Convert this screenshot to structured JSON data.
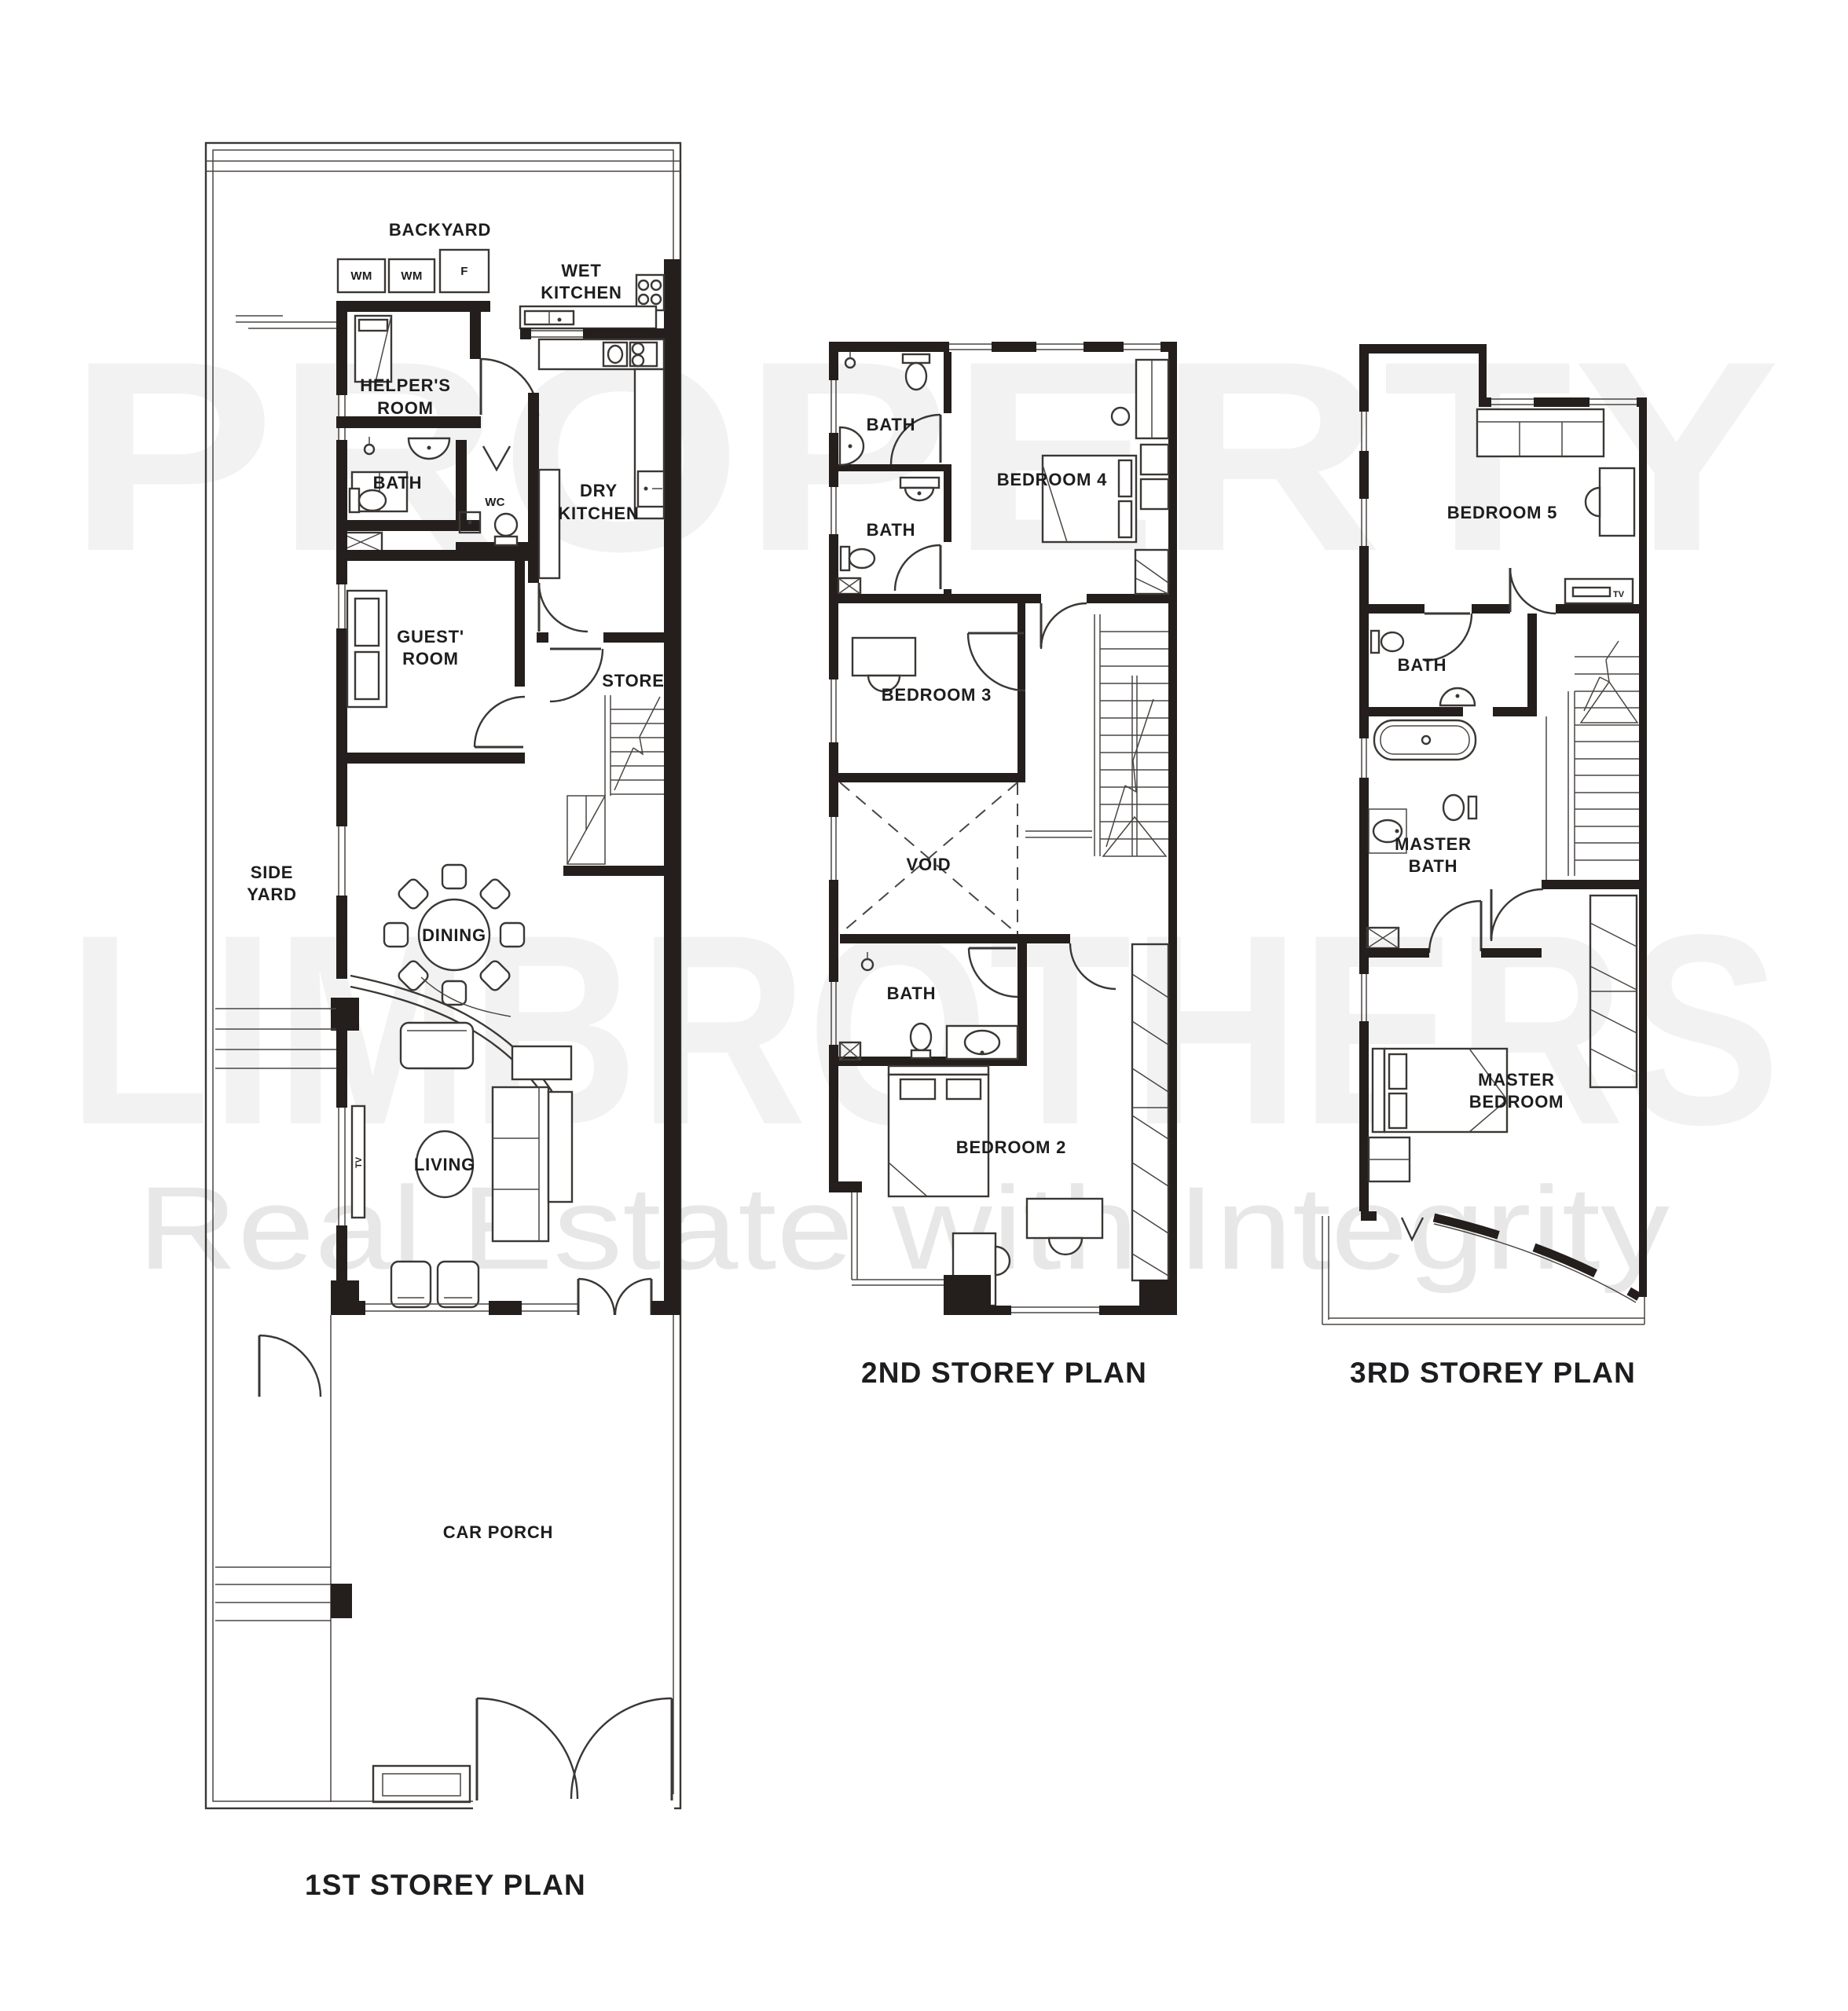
{
  "watermark": {
    "line1": "PROPERTY",
    "line2": "LIMBROTHERS",
    "tagline": "Real Estate with Integrity"
  },
  "plans": {
    "first": {
      "title": "1ST STOREY PLAN",
      "rooms": {
        "backyard": "BACKYARD",
        "wm_left": "WM",
        "wm_right": "WM",
        "fridge": "F",
        "wet_kitchen": [
          "WET",
          "KITCHEN"
        ],
        "helpers_room": [
          "HELPER'S",
          "ROOM"
        ],
        "bath": "BATH",
        "wc": "WC",
        "dry_kitchen": [
          "DRY",
          "KITCHEN"
        ],
        "guest_room": [
          "GUEST'",
          "ROOM"
        ],
        "store": "STORE",
        "side_yard": [
          "SIDE",
          "YARD"
        ],
        "dining": "DINING",
        "living": "LIVING",
        "tv": "TV",
        "car_porch": "CAR PORCH"
      }
    },
    "second": {
      "title": "2ND STOREY PLAN",
      "rooms": {
        "bath_top": "BATH",
        "bedroom4": "BEDROOM 4",
        "bath_mid": "BATH",
        "bedroom3": "BEDROOM 3",
        "void": "VOID",
        "bath_low": "BATH",
        "bedroom2": "BEDROOM 2"
      }
    },
    "third": {
      "title": "3RD STOREY PLAN",
      "rooms": {
        "bedroom5": "BEDROOM 5",
        "tv": "TV",
        "bath": "BATH",
        "master_bath": [
          "MASTER",
          "BATH"
        ],
        "master_bedroom": [
          "MASTER",
          "BEDROOM"
        ]
      }
    }
  },
  "colors": {
    "background": "#ffffff",
    "wall": "#241f1c",
    "line": "#3a3734",
    "text": "#1d1c1e",
    "watermark": "#f2f2f2",
    "tagline": "#e7e7e7"
  }
}
